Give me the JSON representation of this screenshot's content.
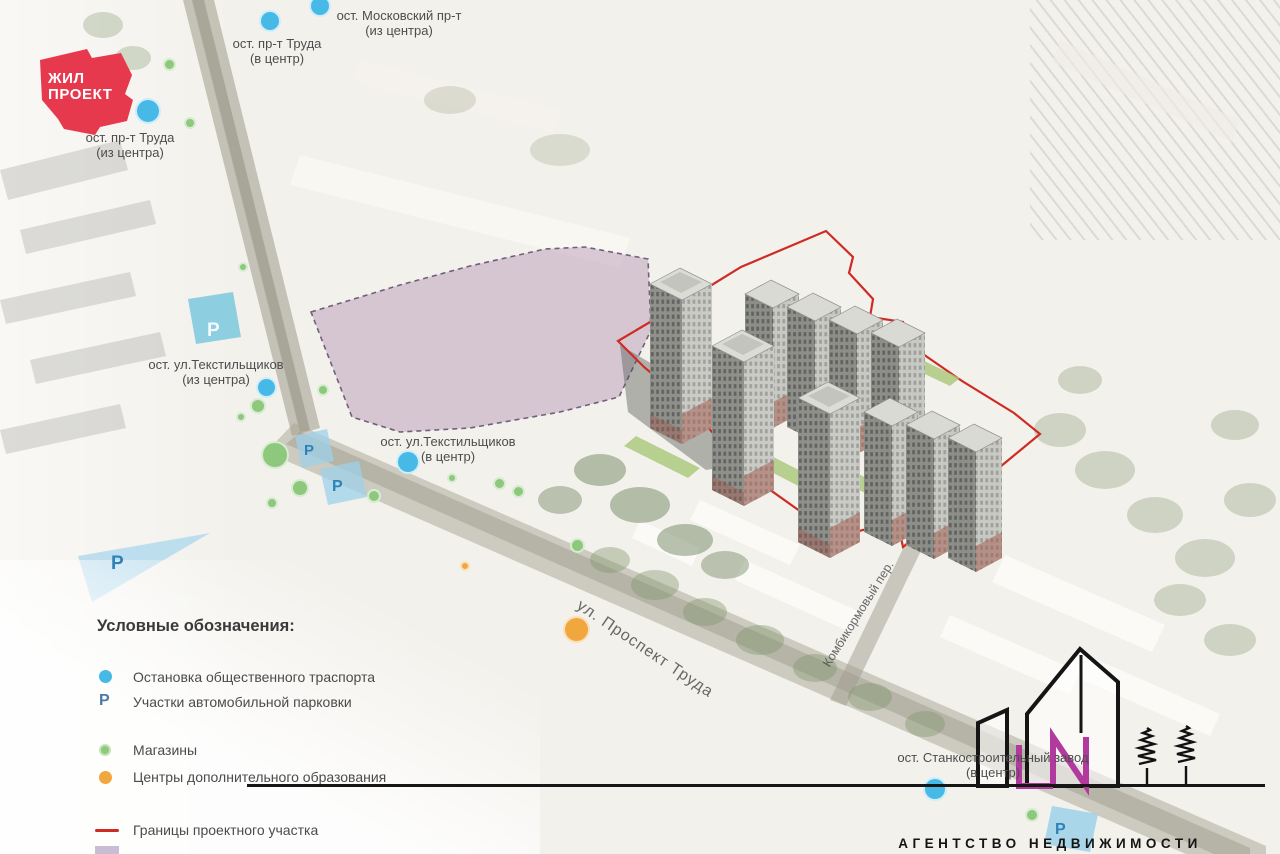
{
  "page": {
    "background": "#f3f1ec",
    "type": "residential masterplan map"
  },
  "developer_logo": {
    "line1": "ЖИЛ",
    "line2": "ПРОЕКТ",
    "color": "#e6394e"
  },
  "agency": {
    "name": "АГЕНТСТВО НЕДВИЖИМОСТИ",
    "monogram": "LN",
    "monogram_color": "#b23a9e"
  },
  "streets": [
    {
      "name": "ул. Проспект Труда"
    },
    {
      "name": "Комбикормовый пер."
    }
  ],
  "transit_stops": [
    {
      "name": "ост. Московский пр-т",
      "direction": "(из центра)"
    },
    {
      "name": "ост. пр-т Труда",
      "direction": "(в центр)"
    },
    {
      "name": "ост. пр-т Труда",
      "direction": "(из центра)"
    },
    {
      "name": "ост. ул.Текстильщиков",
      "direction": "(из центра)"
    },
    {
      "name": "ост. ул.Текстильщиков",
      "direction": "(в центр)"
    },
    {
      "name": "ост. Станкостроительный завод",
      "direction": "(в центр)"
    }
  ],
  "parking_symbol": "Р",
  "legend": {
    "title": "Условные обозначения:",
    "items": [
      {
        "label": "Остановка общественного траспорта",
        "marker": "blue-dot",
        "color": "#47b9e6"
      },
      {
        "label": "Участки автомобильной парковки",
        "marker": "letter-P",
        "symbol": "Р",
        "color": "#4a7ba6"
      },
      {
        "label": "Магазины",
        "marker": "green-dot",
        "color": "#8ec87d"
      },
      {
        "label": "Центры дополнительного образования",
        "marker": "orange-dot",
        "color": "#f0a73e"
      },
      {
        "label": "Границы проектного участка",
        "marker": "red-line",
        "color": "#cf2b25"
      },
      {
        "label": "",
        "marker": "lavender-rect",
        "color": "#c9bdd5"
      }
    ]
  },
  "map_colors": {
    "site_boundary": "#cf2b25",
    "demolition_zone_fill": "#b79cb7",
    "parking_area_fill": "#9fd3e8",
    "road_fill": "#968f78",
    "tower_face": "#c9c9c3",
    "lawn": "#a9c878"
  }
}
